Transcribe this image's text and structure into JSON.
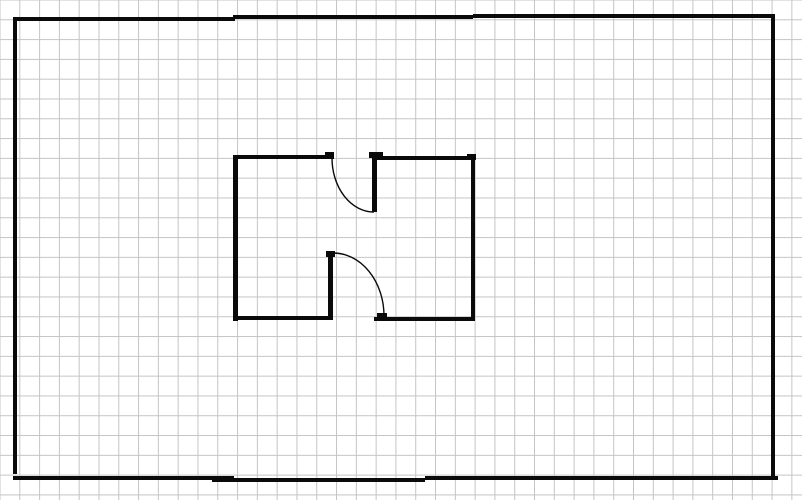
{
  "canvas": {
    "width_px": 802,
    "height_px": 500,
    "background_color": "#ffffff"
  },
  "grid": {
    "cell_size_px": 19.8,
    "line_color": "#c4c4c4",
    "line_width_px": 1,
    "offset_x_px": -0.5,
    "offset_y_px": -0.5
  },
  "drawing": {
    "stroke_color": "#0a0a0a",
    "wall_thickness_px": 4,
    "arc_stroke_width_px": 1.4,
    "outer_walls": [
      {
        "name": "outer-wall-left",
        "rect": [
          13,
          17,
          4,
          457
        ]
      },
      {
        "name": "outer-wall-top-left-segment",
        "rect": [
          13,
          17,
          222,
          4
        ]
      },
      {
        "name": "outer-wall-top-middle-segment",
        "rect": [
          233,
          15,
          240,
          4
        ]
      },
      {
        "name": "outer-wall-top-right-segment",
        "rect": [
          473,
          14,
          302,
          4
        ]
      },
      {
        "name": "outer-wall-right",
        "rect": [
          771,
          14,
          4,
          465
        ]
      },
      {
        "name": "outer-wall-bottom-left-segment",
        "rect": [
          13,
          476,
          221,
          4
        ]
      },
      {
        "name": "outer-wall-bottom-middle-segment",
        "rect": [
          212,
          478,
          213,
          4
        ]
      },
      {
        "name": "outer-wall-bottom-right-segment",
        "rect": [
          425,
          476,
          353,
          4
        ]
      }
    ],
    "inner_room_walls": [
      {
        "name": "room-wall-left",
        "rect": [
          233,
          155,
          5,
          166
        ]
      },
      {
        "name": "room-wall-top-left",
        "rect": [
          233,
          155,
          100,
          4
        ]
      },
      {
        "name": "room-wall-top-right",
        "rect": [
          374,
          156,
          101,
          4
        ]
      },
      {
        "name": "room-wall-right",
        "rect": [
          471,
          156,
          4,
          165
        ]
      },
      {
        "name": "room-wall-bottom-left",
        "rect": [
          233,
          316,
          100,
          4
        ]
      },
      {
        "name": "room-wall-bottom-right",
        "rect": [
          374,
          317,
          101,
          4
        ]
      },
      {
        "name": "room-corner-cap-top-right",
        "rect": [
          467,
          154,
          9,
          6
        ]
      }
    ],
    "doors": [
      {
        "name": "door-top",
        "leaf_rect": [
          372,
          156,
          5,
          56
        ],
        "hinge_plate_rect": [
          369,
          152,
          14,
          6
        ],
        "jamb_rect": [
          325,
          152,
          9,
          7
        ],
        "swing_arc_path": "M 332 158 A 42 54 0 0 0 374 212"
      },
      {
        "name": "door-bottom",
        "leaf_rect": [
          328,
          252,
          5,
          64
        ],
        "hinge_plate_rect": [
          326,
          251,
          9,
          6
        ],
        "jamb_rect": [
          377,
          313,
          10,
          5
        ],
        "swing_arc_path": "M 333 253 A 51 63 0 0 1 384 316"
      }
    ]
  }
}
